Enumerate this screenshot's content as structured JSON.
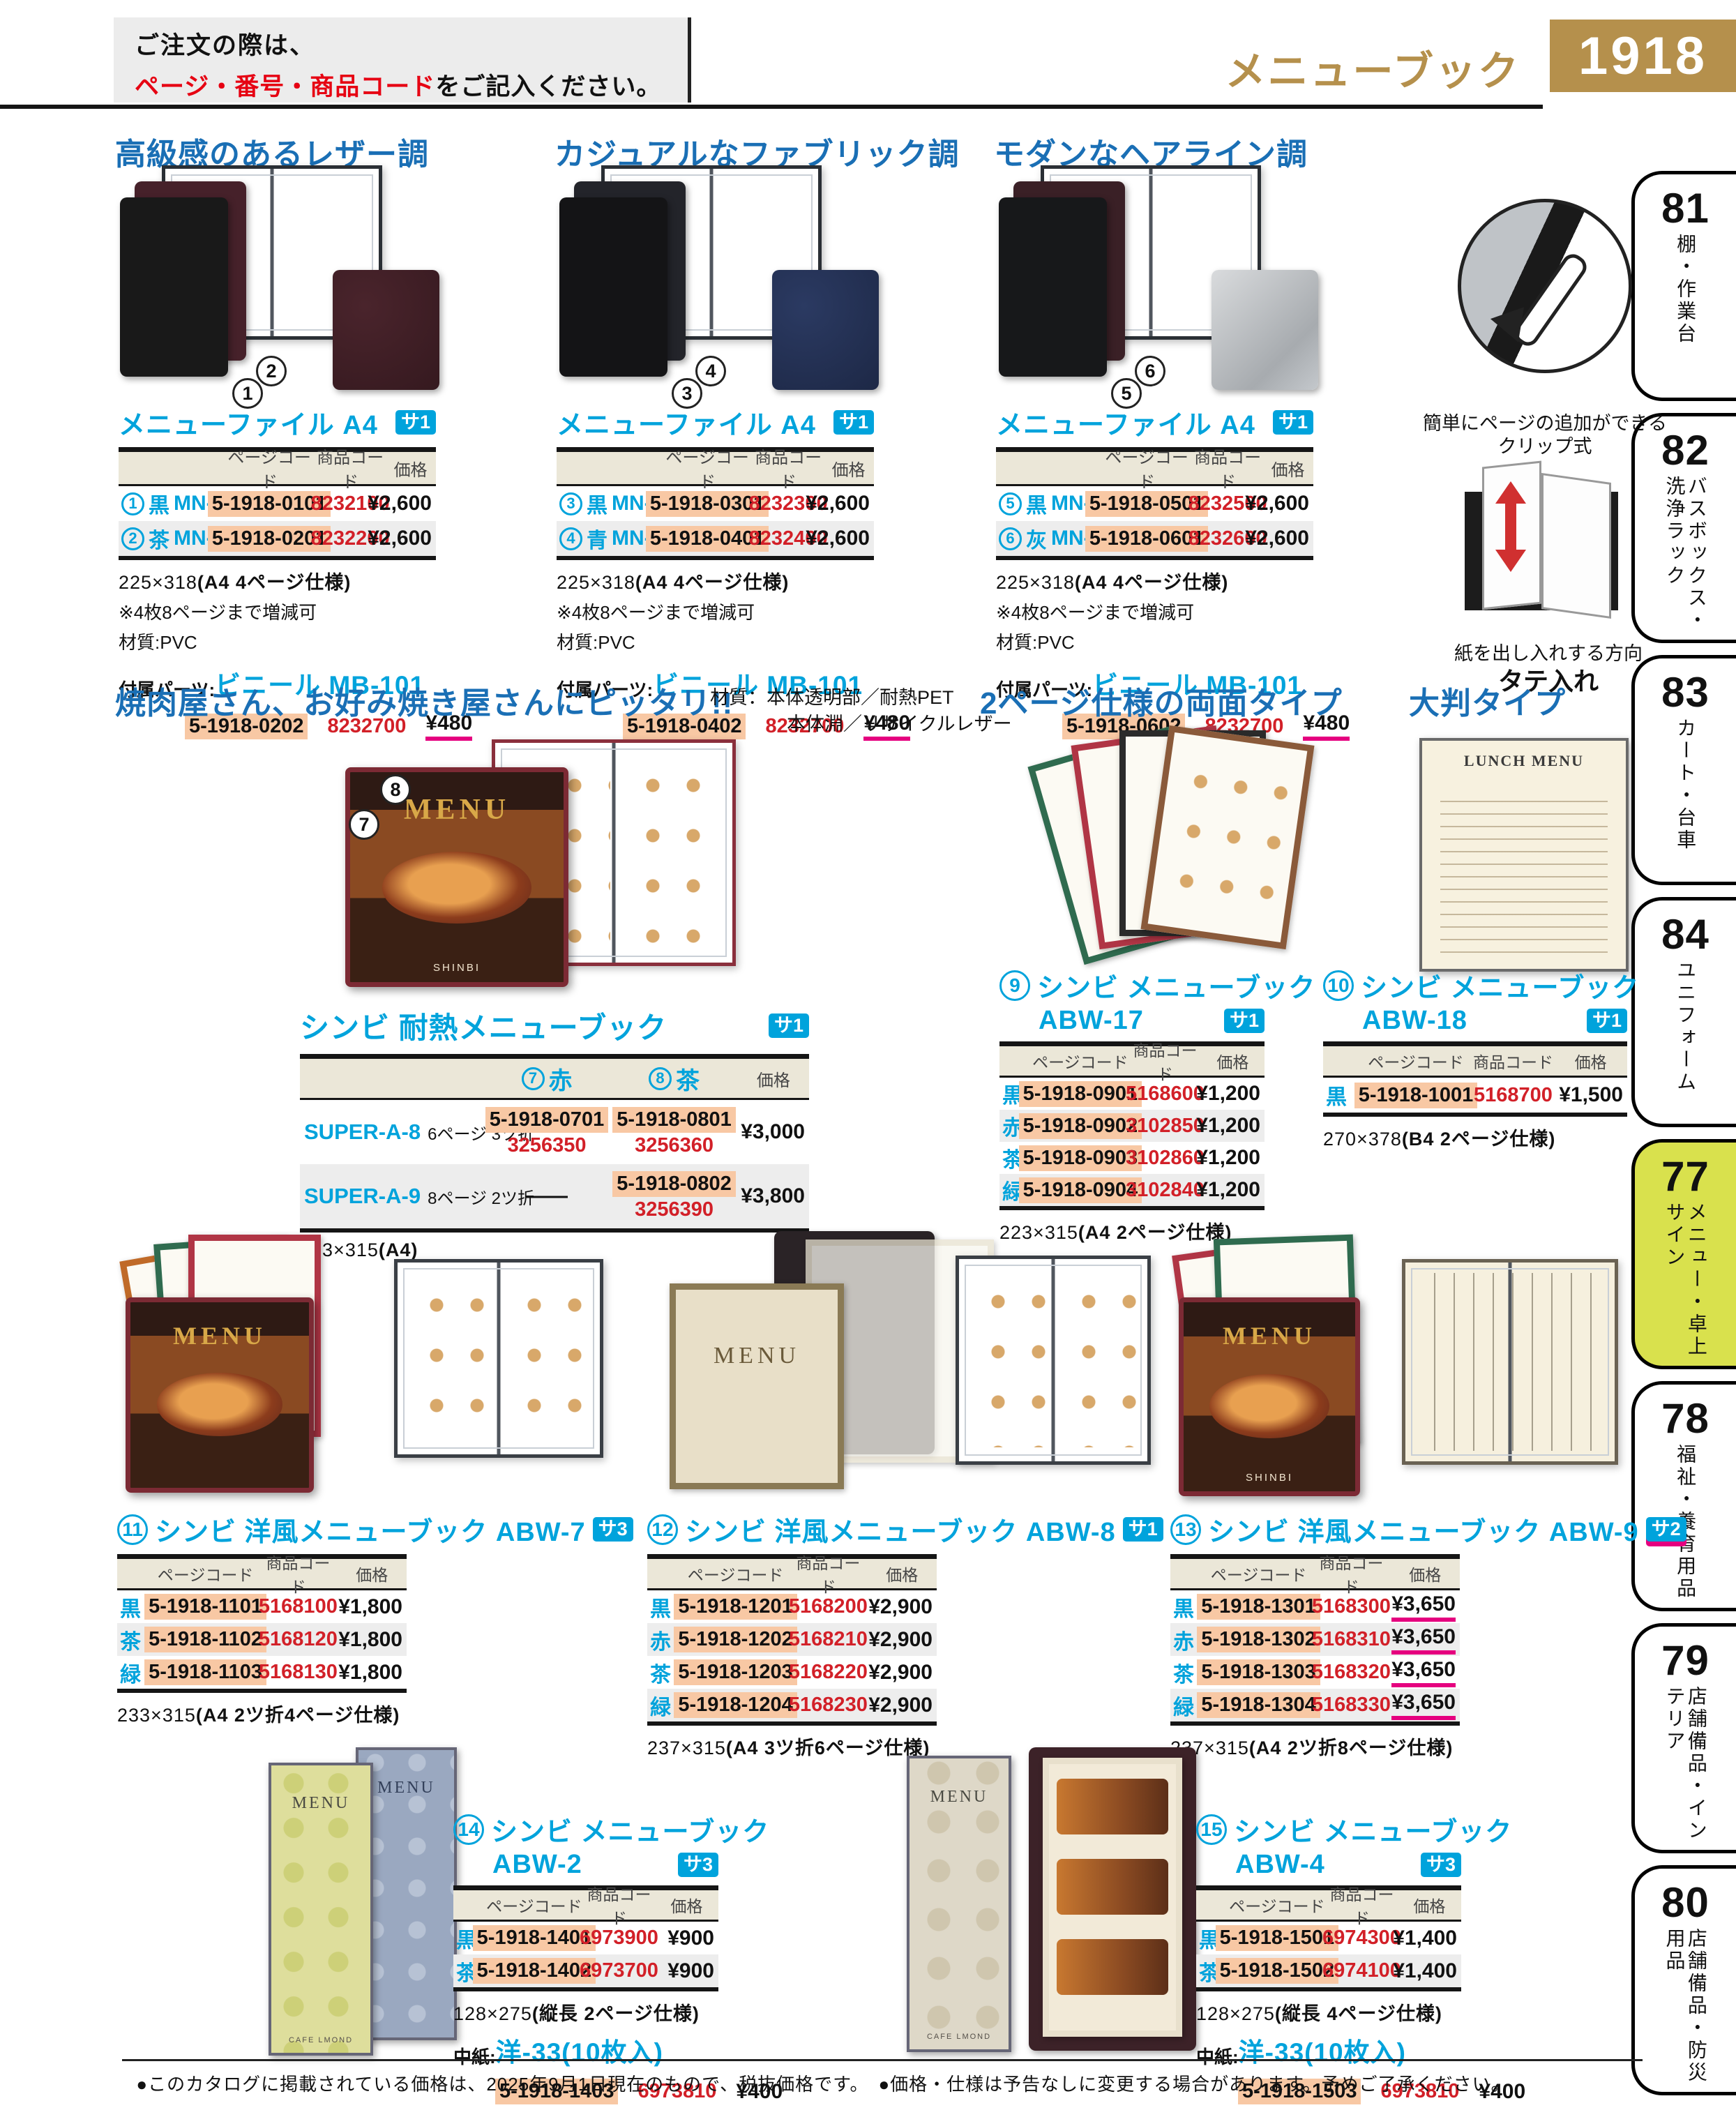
{
  "header": {
    "notice_pre": "ご注文の際は、",
    "notice_em": "ページ・番号・商品コード",
    "notice_post": "をご記入ください。",
    "category": "メニューブック",
    "page_num": "1918"
  },
  "sidebar": {
    "tabs": [
      {
        "num": "81",
        "label": "棚・作業台"
      },
      {
        "num": "82",
        "label": "バスボックス・洗浄ラック"
      },
      {
        "num": "83",
        "label": "カート・台車"
      },
      {
        "num": "84",
        "label": "ユニフォーム"
      },
      {
        "num": "77",
        "label": "メニュー・卓上サイン"
      },
      {
        "num": "78",
        "label": "福祉・養育用品"
      },
      {
        "num": "79",
        "label": "店舗備品・インテリア"
      },
      {
        "num": "80",
        "label": "店舗備品・防災用品"
      }
    ]
  },
  "headings": {
    "leather": "高級感のあるレザー調",
    "fabric": "カジュアルなファブリック調",
    "hairline": "モダンなヘアライン調",
    "yakiniku": "焼肉屋さん、お好み焼き屋さんにピッタリ!!",
    "material_line1": "材質：本体透明部／耐熱PET",
    "material_line2": "本体淵／リサイクルレザー",
    "two_page": "2ページ仕様の両面タイプ",
    "large_format": "大判タイプ"
  },
  "captions": {
    "clip_line1": "簡単にページの追加ができる",
    "clip_line2": "クリップ式",
    "insert_line": "紙を出し入れする方向",
    "insert_bold": "タテ入れ"
  },
  "table_headers": {
    "page_code": "ページコード",
    "item_code": "商品コード",
    "price": "価格"
  },
  "photo_texts": {
    "menu": "MENU",
    "shinbi": "SHINBI",
    "lunch_menu": "LUNCH MENU",
    "cafe_lmond": "CAFE LMOND"
  },
  "menu_files": [
    {
      "title": "メニューファイル A4",
      "badge": "サ1",
      "rows": [
        {
          "num": "1",
          "color": "黒",
          "model": "MN-150",
          "page": "5-1918-0101",
          "item": "8232100",
          "price": "¥2,600"
        },
        {
          "num": "2",
          "color": "茶",
          "model": "MN-150",
          "page": "5-1918-0201",
          "item": "8232200",
          "price": "¥2,600"
        }
      ],
      "size_plain": "225×318",
      "size_paren": "(A4 4ページ仕様)",
      "note1": "※4枚8ページまで増減可",
      "note2": "材質:PVC",
      "parts_label": "付属パーツ:",
      "parts_name": "ビニール MB-101",
      "parts_page": "5-1918-0202",
      "parts_item": "8232700",
      "parts_price": "¥480"
    },
    {
      "title": "メニューファイル A4",
      "badge": "サ1",
      "rows": [
        {
          "num": "3",
          "color": "黒",
          "model": "MN-151",
          "page": "5-1918-0301",
          "item": "8232300",
          "price": "¥2,600"
        },
        {
          "num": "4",
          "color": "青",
          "model": "MN-151",
          "page": "5-1918-0401",
          "item": "8232400",
          "price": "¥2,600"
        }
      ],
      "size_plain": "225×318",
      "size_paren": "(A4 4ページ仕様)",
      "note1": "※4枚8ページまで増減可",
      "note2": "材質:PVC",
      "parts_label": "付属パーツ:",
      "parts_name": "ビニール MB-101",
      "parts_page": "5-1918-0402",
      "parts_item": "8232700",
      "parts_price": "¥480"
    },
    {
      "title": "メニューファイル A4",
      "badge": "サ1",
      "rows": [
        {
          "num": "5",
          "color": "黒",
          "model": "MN-152",
          "page": "5-1918-0501",
          "item": "8232500",
          "price": "¥2,600"
        },
        {
          "num": "6",
          "color": "灰",
          "model": "MN-152",
          "page": "5-1918-0601",
          "item": "8232600",
          "price": "¥2,600"
        }
      ],
      "size_plain": "225×318",
      "size_paren": "(A4 4ページ仕様)",
      "note1": "※4枚8ページまで増減可",
      "note2": "材質:PVC",
      "parts_label": "付属パーツ:",
      "parts_name": "ビニール MB-101",
      "parts_page": "5-1918-0602",
      "parts_item": "8232700",
      "parts_price": "¥480"
    }
  ],
  "heat_book": {
    "title": "シンビ 耐熱メニューブック",
    "badge": "サ1",
    "col_red_num": "7",
    "col_red": "赤",
    "col_brown_num": "8",
    "col_brown": "茶",
    "rows": [
      {
        "model": "SUPER-A-8",
        "spec": "6ページ 3ツ折",
        "red_page": "5-1918-0701",
        "red_item": "3256350",
        "brown_page": "5-1918-0801",
        "brown_item": "3256360",
        "price": "¥3,000"
      },
      {
        "model": "SUPER-A-9",
        "spec": "8ページ 2ツ折",
        "red_dash": "——",
        "brown_page": "5-1918-0802",
        "brown_item": "3256390",
        "price": "¥3,800"
      }
    ],
    "size_plain": "223×315",
    "size_paren": "(A4)",
    "marker_left": "7",
    "marker_right": "8"
  },
  "abw_books": [
    {
      "num": "9",
      "title": "シンビ メニューブック",
      "model": "ABW-17",
      "badge": "サ1",
      "rows": [
        {
          "color": "黒",
          "page": "5-1918-0901",
          "item": "5168600",
          "price": "¥1,200"
        },
        {
          "color": "赤",
          "page": "5-1918-0902",
          "item": "3102850",
          "price": "¥1,200"
        },
        {
          "color": "茶",
          "page": "5-1918-0903",
          "item": "3102860",
          "price": "¥1,200"
        },
        {
          "color": "緑",
          "page": "5-1918-0904",
          "item": "3102840",
          "price": "¥1,200"
        }
      ],
      "size_plain": "223×315",
      "size_paren": "(A4 2ページ仕様)"
    },
    {
      "num": "10",
      "title": "シンビ メニューブック",
      "model": "ABW-18",
      "badge": "サ1",
      "rows": [
        {
          "color": "黒",
          "page": "5-1918-1001",
          "item": "5168700",
          "price": "¥1,500"
        }
      ],
      "size_plain": "270×378",
      "size_paren": "(B4 2ページ仕様)"
    }
  ],
  "western_books": [
    {
      "num": "11",
      "title": "シンビ 洋風メニューブック ABW-7",
      "badge": "サ3",
      "rows": [
        {
          "color": "黒",
          "page": "5-1918-1101",
          "item": "5168100",
          "price": "¥1,800"
        },
        {
          "color": "茶",
          "page": "5-1918-1102",
          "item": "5168120",
          "price": "¥1,800"
        },
        {
          "color": "緑",
          "page": "5-1918-1103",
          "item": "5168130",
          "price": "¥1,800"
        }
      ],
      "size_plain": "233×315",
      "size_paren": "(A4 2ツ折4ページ仕様)"
    },
    {
      "num": "12",
      "title": "シンビ 洋風メニューブック ABW-8",
      "badge": "サ1",
      "rows": [
        {
          "color": "黒",
          "page": "5-1918-1201",
          "item": "5168200",
          "price": "¥2,900"
        },
        {
          "color": "赤",
          "page": "5-1918-1202",
          "item": "5168210",
          "price": "¥2,900"
        },
        {
          "color": "茶",
          "page": "5-1918-1203",
          "item": "5168220",
          "price": "¥2,900"
        },
        {
          "color": "緑",
          "page": "5-1918-1204",
          "item": "5168230",
          "price": "¥2,900"
        }
      ],
      "size_plain": "237×315",
      "size_paren": "(A4 3ツ折6ページ仕様)"
    },
    {
      "num": "13",
      "title": "シンビ 洋風メニューブック ABW-9",
      "badge": "サ2",
      "rows": [
        {
          "color": "黒",
          "page": "5-1918-1301",
          "item": "5168300",
          "price": "¥3,650"
        },
        {
          "color": "赤",
          "page": "5-1918-1302",
          "item": "5168310",
          "price": "¥3,650"
        },
        {
          "color": "茶",
          "page": "5-1918-1303",
          "item": "5168320",
          "price": "¥3,650"
        },
        {
          "color": "緑",
          "page": "5-1918-1304",
          "item": "5168330",
          "price": "¥3,650"
        }
      ],
      "size_plain": "237×315",
      "size_paren": "(A4 2ツ折8ページ仕様)"
    }
  ],
  "simple_books": [
    {
      "num": "14",
      "title": "シンビ メニューブック",
      "model": "ABW-2",
      "badge": "サ3",
      "rows": [
        {
          "color": "黒",
          "page": "5-1918-1401",
          "item": "6973900",
          "price": "¥900"
        },
        {
          "color": "茶",
          "page": "5-1918-1402",
          "item": "6973700",
          "price": "¥900"
        }
      ],
      "size_plain": "128×275",
      "size_paren": "(縦長 2ページ仕様)",
      "paper_label": "中紙:",
      "paper_name": "洋-33(10枚入)",
      "paper_page": "5-1918-1403",
      "paper_item": "6973810",
      "paper_price": "¥400"
    },
    {
      "num": "15",
      "title": "シンビ メニューブック",
      "model": "ABW-4",
      "badge": "サ3",
      "rows": [
        {
          "color": "黒",
          "page": "5-1918-1501",
          "item": "6974300",
          "price": "¥1,400"
        },
        {
          "color": "茶",
          "page": "5-1918-1502",
          "item": "6974100",
          "price": "¥1,400"
        }
      ],
      "size_plain": "128×275",
      "size_paren": "(縦長 4ページ仕様)",
      "paper_label": "中紙:",
      "paper_name": "洋-33(10枚入)",
      "paper_page": "5-1918-1503",
      "paper_item": "6973810",
      "paper_price": "¥400"
    }
  ],
  "footer": {
    "note": "●このカタログに掲載されている価格は、2025年9月1日現在のもので、税抜価格です。　●価格・仕様は予告なしに変更する場合があります。予めご了承ください。"
  },
  "colors": {
    "accent_blue": "#1a6fb5",
    "cyan": "#00a3dc",
    "gold": "#b5904c",
    "highlight_salmon": "#f8c8a4",
    "code_red": "#d22028",
    "underline_pink": "#e5007f",
    "tab_active": "#d9e14d"
  }
}
